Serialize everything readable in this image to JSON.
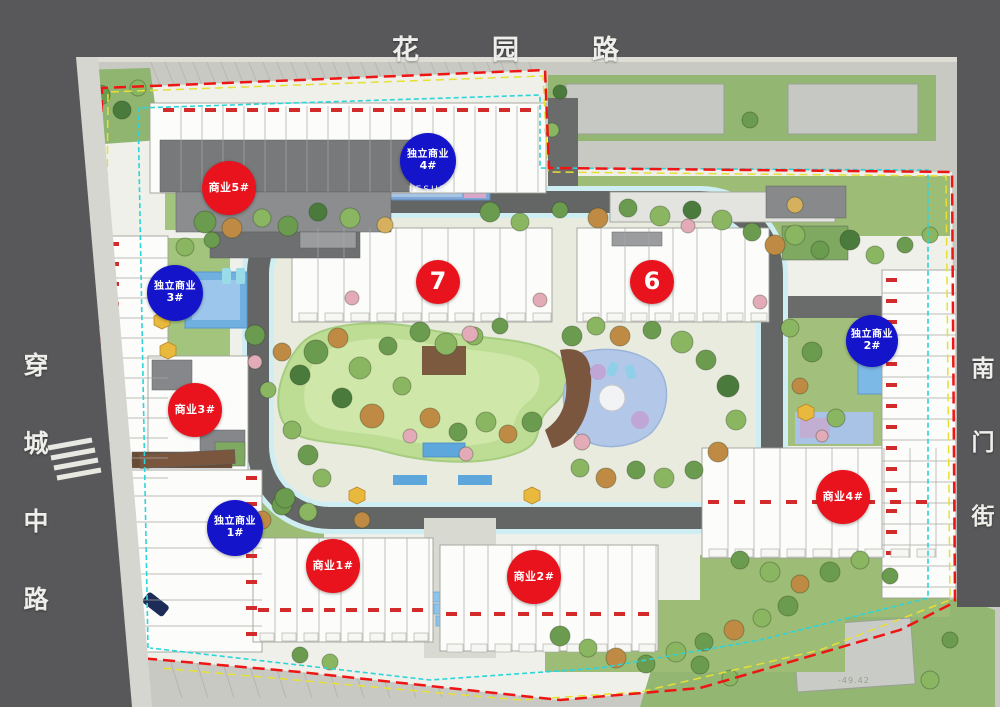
{
  "plan": {
    "roads": {
      "top": "花园路",
      "left": "穿城中路",
      "right": "南门街"
    },
    "pool_label": "LESUE",
    "elevation_note": "-49.42",
    "badges": {
      "red": [
        {
          "label": "商业5#"
        },
        {
          "label": "商业3#"
        },
        {
          "label": "商业1#"
        },
        {
          "label": "商业2#"
        },
        {
          "label": "商业4#"
        }
      ],
      "blue": [
        {
          "line1": "独立商业",
          "line2": "4#"
        },
        {
          "line1": "独立商业",
          "line2": "3#"
        },
        {
          "line1": "独立商业",
          "line2": "1#"
        },
        {
          "line1": "独立商业",
          "line2": "2#"
        }
      ],
      "buildings": [
        {
          "num": "7"
        },
        {
          "num": "6"
        }
      ]
    },
    "colors": {
      "boundary_red": "#ee1515",
      "line_yellow": "#e6e035",
      "line_cyan": "#2fd3da",
      "badge_red": "#e8131d",
      "badge_blue": "#1414cb",
      "road_gray": "#58585a",
      "lawn_green": "#bcdd93",
      "water_blue": "#6fb3e3"
    }
  }
}
